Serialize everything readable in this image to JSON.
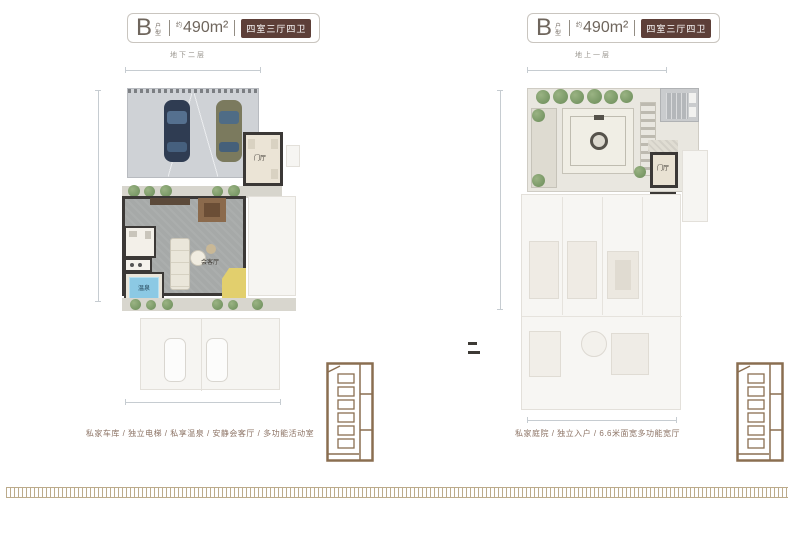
{
  "left": {
    "header": {
      "unit": "B",
      "unit_sub": "户型",
      "approx": "约",
      "area": "490m²",
      "badge": "四室三厅四卫"
    },
    "floor_label": "地下二层",
    "rooms": {
      "entry": "门厅",
      "living": "会客厅",
      "spa": "温泉"
    },
    "caption": "私家车库 / 独立电梯 / 私享温泉 / 安静会客厅 / 多功能活动室"
  },
  "right": {
    "header": {
      "unit": "B",
      "unit_sub": "户型",
      "approx": "约",
      "area": "490m²",
      "badge": "四室三厅四卫"
    },
    "floor_label": "地上一层",
    "rooms": {
      "entry": "门厅"
    },
    "caption": "私家庭院 / 独立入户 / 6.6米面宽多功能宽厅"
  },
  "colors": {
    "badge_bg": "#5d3f38",
    "caption_text": "#8d7466",
    "border_pattern": "#bcab8b",
    "wall": "#3b3836",
    "pool": "#8cc9e4"
  }
}
